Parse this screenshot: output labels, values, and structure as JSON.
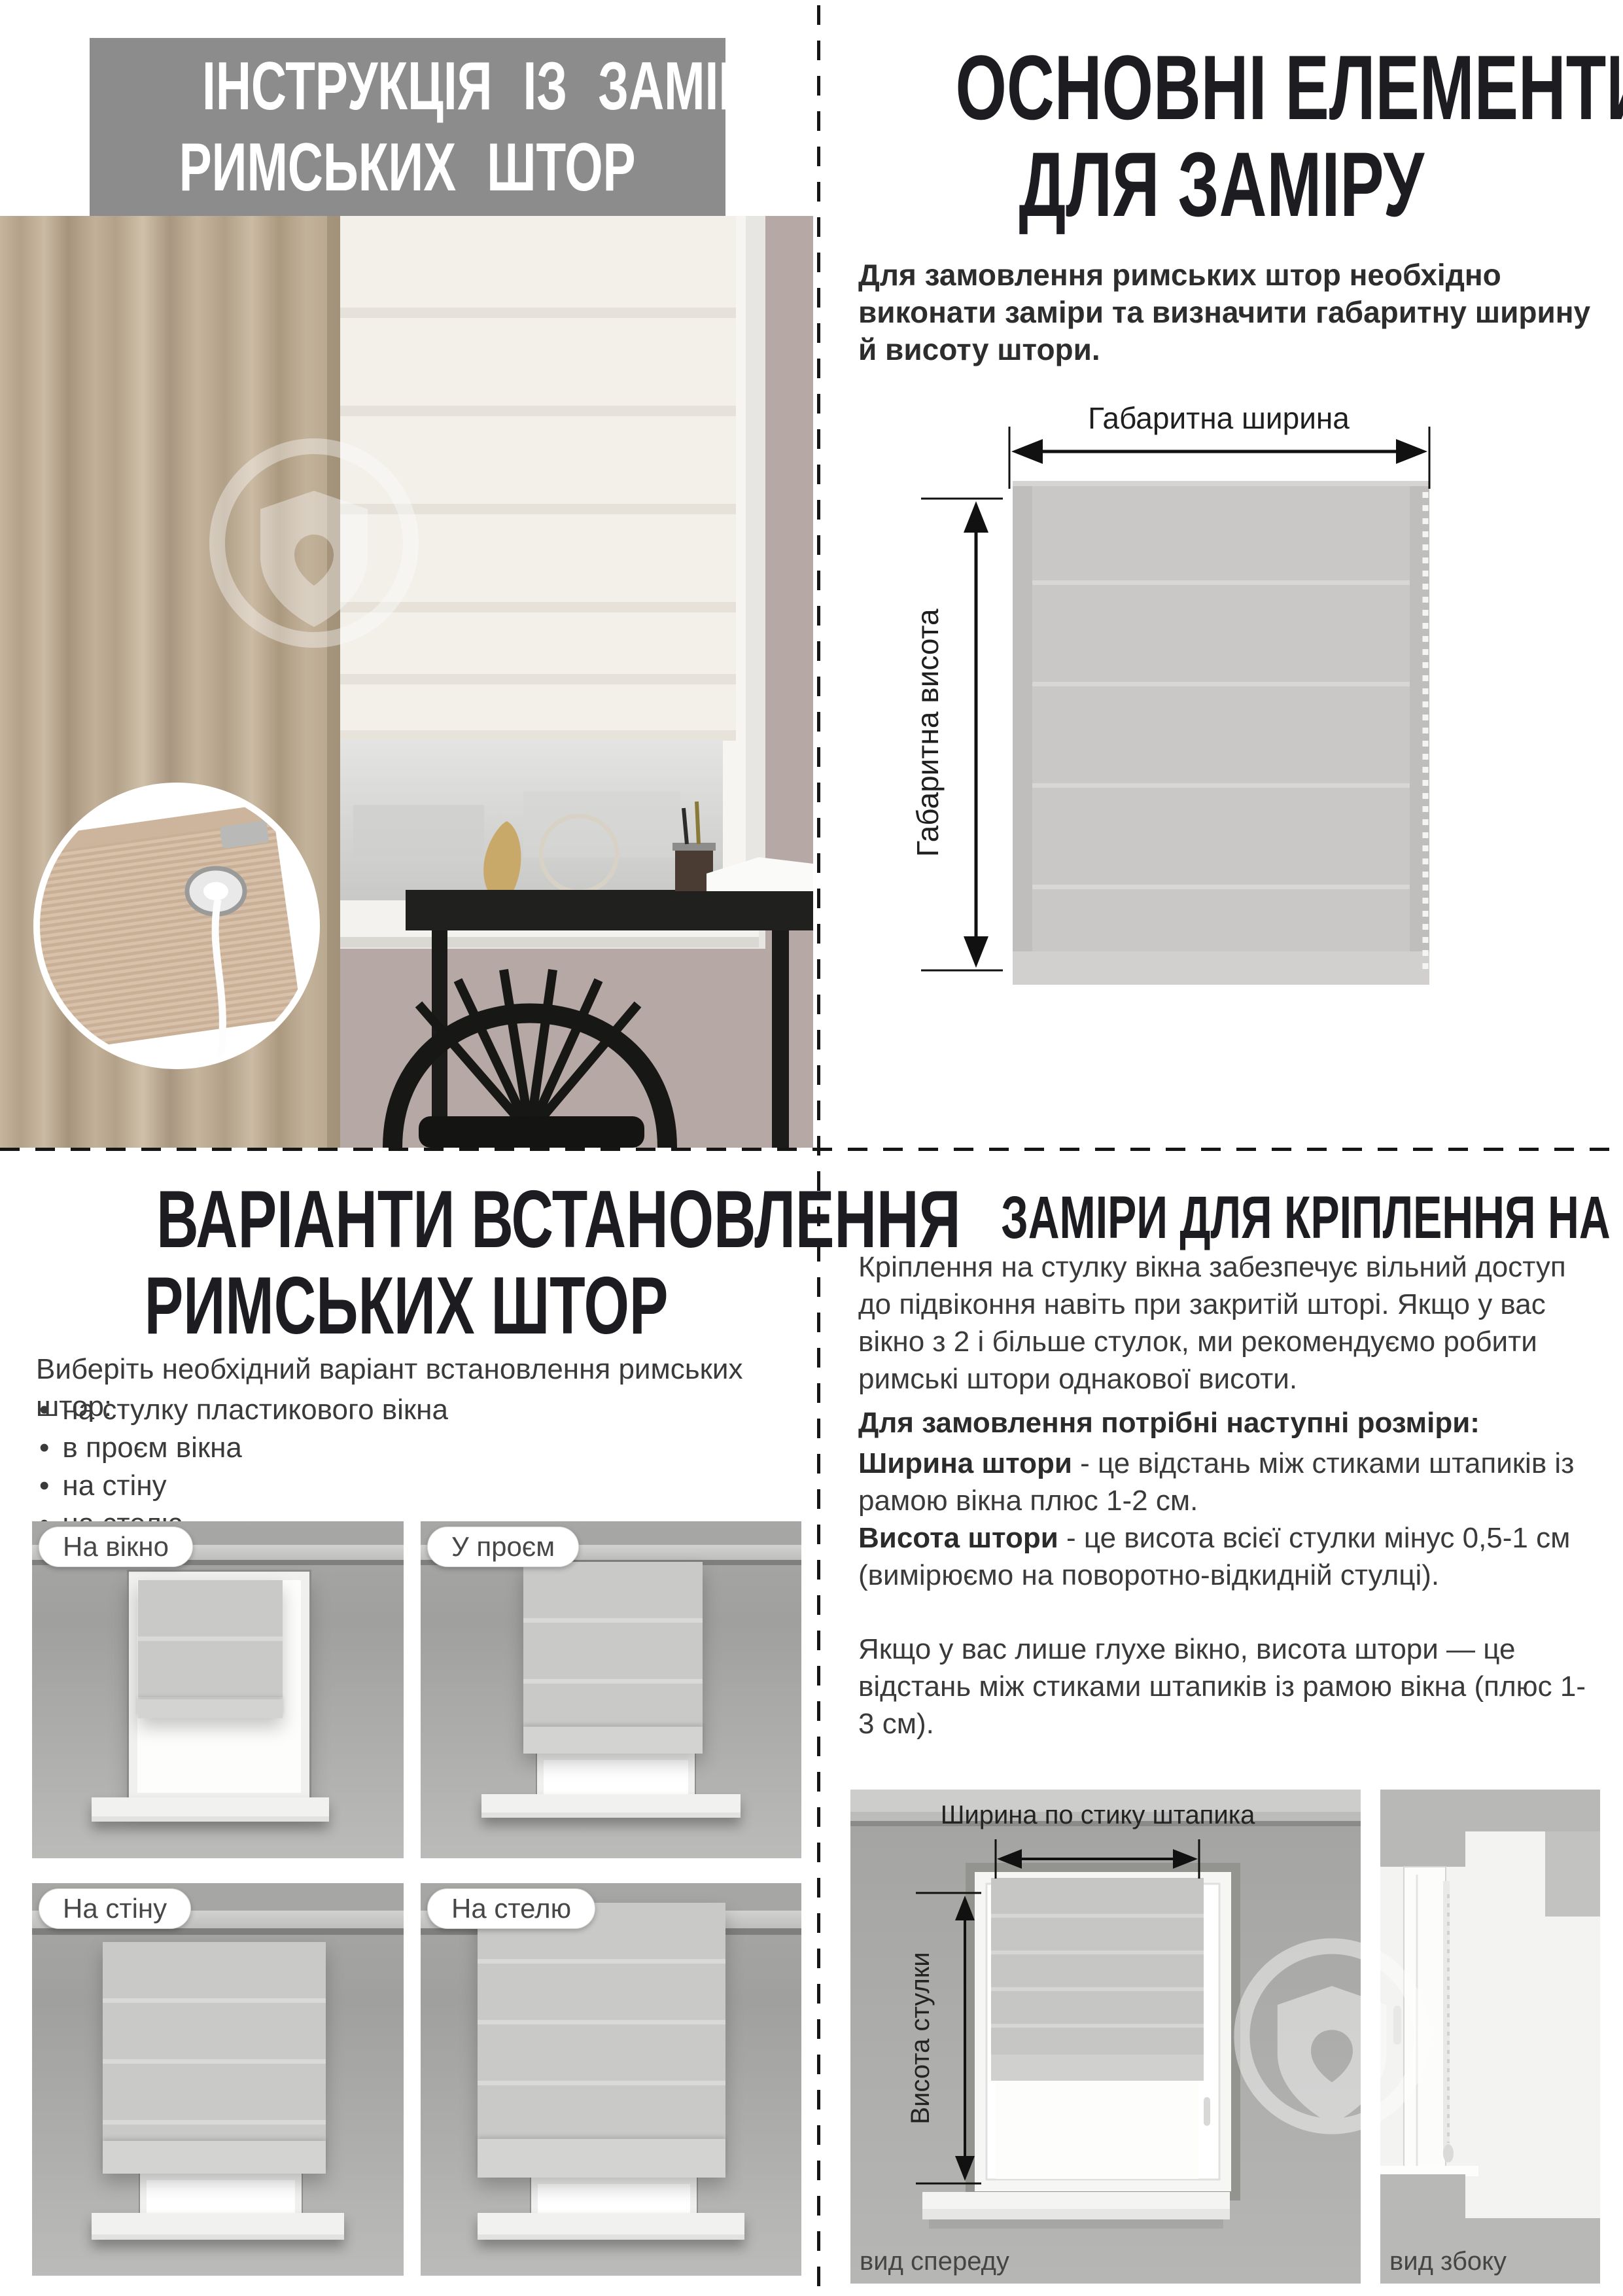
{
  "colors": {
    "banner_bg": "#8c8c8c",
    "banner_text": "#ffffff",
    "heading_text": "#1d1d21",
    "body_text": "#3a3a3a",
    "diagram_gray": "#c9c9c7"
  },
  "top_left": {
    "title_line1": "ІНСТРУКЦІЯ ІЗ ЗАМІРУ",
    "title_line2": "РИМСЬКИХ ШТОР"
  },
  "top_right": {
    "title_line1": "ОСНОВНІ ЕЛЕМЕНТИ",
    "title_line2": "ДЛЯ ЗАМІРУ",
    "intro": "Для замовлення римських штор необхідно виконати заміри та визначити габаритну ширину й висоту штори.",
    "diagram": {
      "width_label": "Габаритна ширина",
      "height_label": "Габаритна висота"
    }
  },
  "bottom_left": {
    "title_line1": "ВАРІАНТИ ВСТАНОВЛЕННЯ",
    "title_line2": "РИМСЬКИХ ШТОР",
    "intro": "Виберіть необхідний варіант встановлення римських штор:",
    "bullets": [
      "на стулку пластикового вікна",
      "в проєм вікна",
      "на стіну",
      "на стелю"
    ],
    "variants": [
      {
        "label": "На вікно"
      },
      {
        "label": "У проєм"
      },
      {
        "label": "На стіну"
      },
      {
        "label": "На стелю"
      }
    ]
  },
  "bottom_right": {
    "title": "ЗАМІРИ ДЛЯ КРІПЛЕННЯ НА СТУЛКУ ВІКНА",
    "para1": "Кріплення на стулку вікна забезпечує вільний доступ до підвіконня навіть при закритій шторі. Якщо у вас вікно з 2 і більше стулок, ми рекомендуємо робити римські штори однакової висоти.",
    "sizes_heading": "Для замовлення потрібні наступні розміри:",
    "width_term": "Ширина штори",
    "width_def": " - це відстань між стиками штапиків із рамою вікна плюс 1-2 см.",
    "height_term": "Висота штори",
    "height_def": " - це висота всієї стулки мінус 0,5-1 см (вимірюємо на поворотно-відкидній стулці).",
    "para2": "Якщо у вас лише глухе вікно, висота штори — це відстань між стиками штапиків із рамою вікна (плюс 1-3 см).",
    "diagram": {
      "width_label": "Ширина по стику штапика",
      "height_label": "Висота стулки",
      "front_label": "вид спереду",
      "side_label": "вид збоку"
    }
  }
}
